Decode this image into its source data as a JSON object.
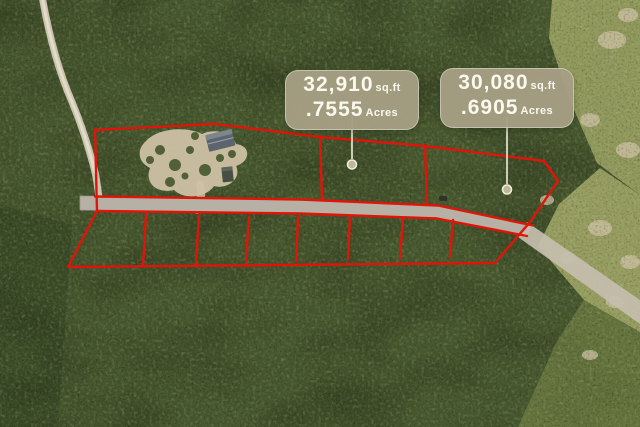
{
  "lot_labels": [
    {
      "sqft_value": "32,910",
      "sqft_unit": "sq.ft",
      "acres_value": ".7555",
      "acres_unit": "Acres"
    },
    {
      "sqft_value": "30,080",
      "sqft_unit": "sq.ft",
      "acres_value": ".6905",
      "acres_unit": "Acres"
    }
  ],
  "colors": {
    "boundary_red": "#e01408",
    "label_background": "#a59e84",
    "label_text": "#fbf8ed",
    "leader_line": "#efecdc",
    "leader_marker_fill": "#bdb896",
    "vegetation_dark": "#47582e",
    "scrub_light": "#9aa162",
    "road_gray": "#b7b1a5",
    "sand": "#cfc3a6"
  }
}
